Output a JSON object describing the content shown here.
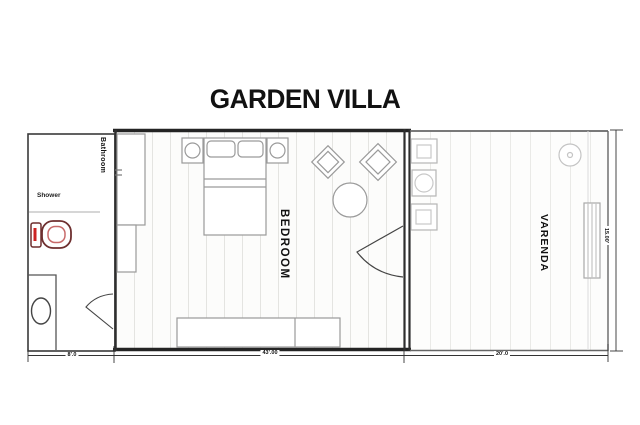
{
  "title": "GARDEN VILLA",
  "rooms": {
    "bathroom": {
      "label": "Bathroom"
    },
    "bedroom": {
      "label": "BEDROOM"
    },
    "veranda": {
      "label": "VARENDA"
    }
  },
  "labels": {
    "shower": "Shower"
  },
  "dimensions": {
    "bathroom_width": "8'.0",
    "bedroom_width": "43'.00",
    "veranda_width": "20'.0",
    "right_height": "15.00'"
  },
  "colors": {
    "wall": "#242424",
    "thin_wall": "#666666",
    "furniture_line": "#9a9a9a",
    "veranda_line": "#b5b5b5",
    "toilet_outline": "#6e2f2f",
    "toilet_accent": "#cc2222",
    "floor_stripe_bedroom": "#e4e4e1",
    "floor_stripe_veranda": "#eaeae7"
  },
  "furniture": {
    "bathroom": [
      "toilet",
      "shower-line",
      "pedestal-sink",
      "door-swing"
    ],
    "bedroom": [
      "double-bed",
      "pillows",
      "nightstand-left",
      "lamp-left",
      "nightstand-right",
      "lamp-right",
      "armchair-left",
      "armchair-right",
      "round-table",
      "wardrobe",
      "closet",
      "door-swing"
    ],
    "veranda": [
      "chair-top",
      "side-table",
      "chair-bottom",
      "ceiling-light",
      "steps"
    ]
  }
}
